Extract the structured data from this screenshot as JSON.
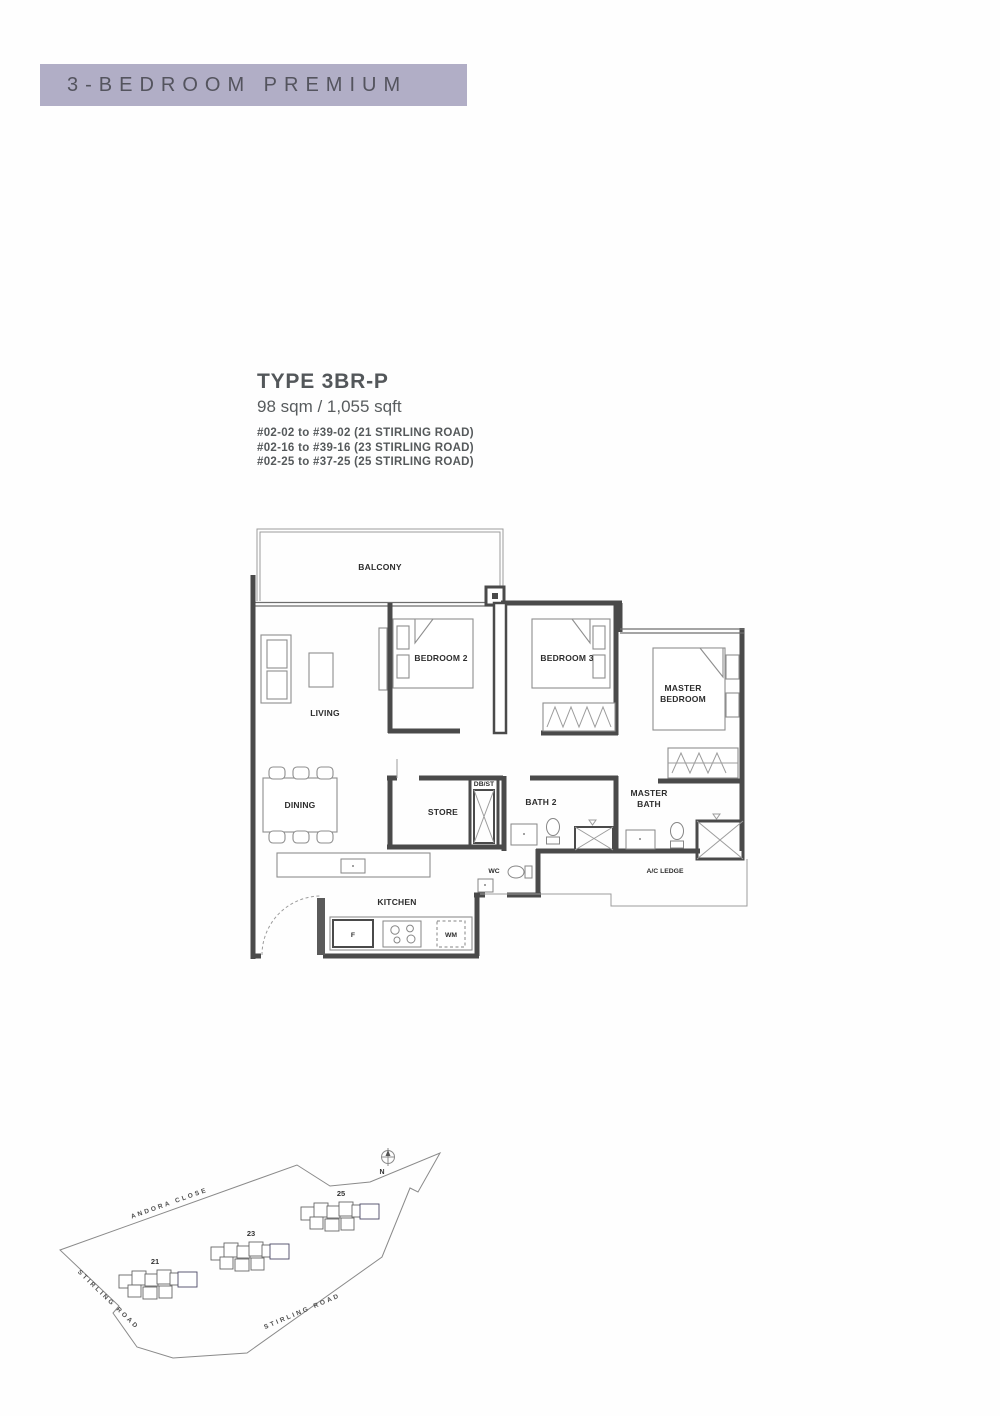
{
  "banner": {
    "title": "3-BEDROOM PREMIUM",
    "bg_color": "#b1aec6",
    "text_color": "#54545e"
  },
  "unit_info": {
    "type": "TYPE 3BR-P",
    "area": "98 sqm / 1,055 sqft",
    "stacks": [
      "#02-02 to #39-02 (21 STIRLING ROAD)",
      "#02-16 to #39-16 (23 STIRLING ROAD)",
      "#02-25 to #37-25 (25 STIRLING ROAD)"
    ]
  },
  "floor_plan": {
    "labels": {
      "balcony": "BALCONY",
      "living": "LIVING",
      "bedroom2": "BEDROOM 2",
      "bedroom3": "BEDROOM 3",
      "master_bedroom_line1": "MASTER",
      "master_bedroom_line2": "BEDROOM",
      "dining": "DINING",
      "store": "STORE",
      "db_st": "DB/ST",
      "bath2": "BATH 2",
      "master_bath_line1": "MASTER",
      "master_bath_line2": "BATH",
      "wc": "WC",
      "ac_ledge": "A/C LEDGE",
      "kitchen": "KITCHEN",
      "fridge": "F",
      "washing_machine": "WM"
    }
  },
  "site_map": {
    "north_label": "N",
    "roads": {
      "top": "ANDORA CLOSE",
      "left": "STIRLING ROAD",
      "middle": "STIRLING ROAD"
    },
    "blocks": [
      {
        "number": "21"
      },
      {
        "number": "23"
      },
      {
        "number": "25"
      }
    ],
    "highlight_color": "#918eb6"
  }
}
